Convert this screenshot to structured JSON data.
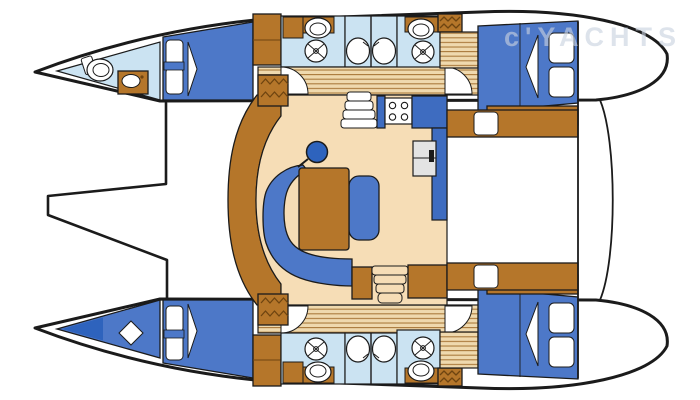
{
  "watermark": {
    "text": "c'YACHTS"
  },
  "palette": {
    "outline": "#1b1b1b",
    "wood": "#b5762a",
    "woodDark": "#6e4410",
    "plankBg": "#efd9ae",
    "plankLine": "#aa7a3c",
    "cream": "#f6ddb6",
    "bed": "#4d78c8",
    "counter": "#3e6cc0",
    "accent": "#2e63bd",
    "bath": "#cbe3f2",
    "fixture": "#ffffff",
    "fridge": "#e3e3e3",
    "watermarkColor": "#c9d2e0"
  },
  "figure": {
    "type": "diagram",
    "subject": "catamaran-interior-floor-plan",
    "features": [
      "bow-head",
      "bow-berth",
      "forward-cabin",
      "mid-head",
      "shower-tray",
      "aft-cabin",
      "saloon",
      "galley-stove",
      "galley-sink-steps",
      "fridge",
      "dinette-table",
      "c-sofa",
      "nav-stool",
      "companionway-steps",
      "cockpit",
      "forward-crossbeam",
      "transom-platform"
    ]
  }
}
